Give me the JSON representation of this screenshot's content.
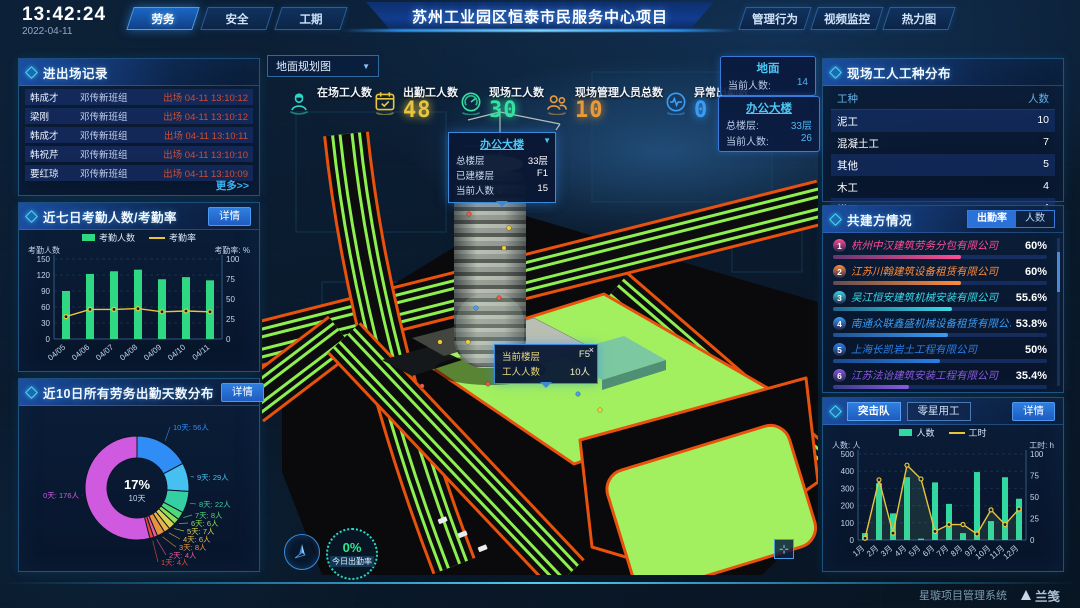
{
  "header": {
    "time": "13:42:24",
    "date": "2022-04-11",
    "left_tabs": [
      "劳务",
      "安全",
      "工期"
    ],
    "active_left_tab": "劳务",
    "title": "苏州工业园区恒泰市民服务中心项目",
    "right_tabs": [
      "管理行为",
      "视频监控",
      "热力图"
    ]
  },
  "entry_exit": {
    "title": "进出场记录",
    "more": "更多>>",
    "rows": [
      {
        "name": "韩成才",
        "team": "邓传新班组",
        "event": "出场 04-11 13:10:12"
      },
      {
        "name": "梁刚",
        "team": "邓传新班组",
        "event": "出场 04-11 13:10:12"
      },
      {
        "name": "韩成才",
        "team": "邓传新班组",
        "event": "出场 04-11 13:10:11"
      },
      {
        "name": "韩祝芹",
        "team": "邓传新班组",
        "event": "出场 04-11 13:10:10"
      },
      {
        "name": "要红琼",
        "team": "邓传新班组",
        "event": "出场 04-11 13:10:09"
      }
    ]
  },
  "panels": {
    "detail": "详情",
    "attendance7_title": "近七日考勤人数/考勤率",
    "distribution_title": "近10日所有劳务出勤天数分布",
    "worker_types": {
      "title": "现场工人工种分布",
      "col_type": "工种",
      "col_count": "人数",
      "rows": [
        [
          "泥工",
          "10"
        ],
        [
          "混凝土工",
          "7"
        ],
        [
          "其他",
          "5"
        ],
        [
          "木工",
          "4"
        ],
        [
          "塔司",
          "4"
        ]
      ]
    },
    "partners": {
      "title": "共建方情况",
      "tabs": [
        "出勤率",
        "人数"
      ],
      "active_tab": "出勤率",
      "rows": [
        {
          "rank": "1",
          "name": "杭州中汉建筑劳务分包有限公司",
          "value": "60%",
          "pct": 60,
          "color": "#ff4d94"
        },
        {
          "rank": "2",
          "name": "江苏川翰建筑设备租赁有限公司",
          "value": "60%",
          "pct": 60,
          "color": "#ff8c3a"
        },
        {
          "rank": "3",
          "name": "吴江恒安建筑机械安装有限公司",
          "value": "55.6%",
          "pct": 55.6,
          "color": "#3ad9e8"
        },
        {
          "rank": "4",
          "name": "南通众联鑫盛机械设备租赁有限公司",
          "value": "53.8%",
          "pct": 53.8,
          "color": "#3a9df5"
        },
        {
          "rank": "5",
          "name": "上海长凯岩土工程有限公司",
          "value": "50%",
          "pct": 50,
          "color": "#2a7fe8"
        },
        {
          "rank": "6",
          "name": "江苏法诒建筑安装工程有限公司",
          "value": "35.4%",
          "pct": 35.4,
          "color": "#8a5ae0"
        }
      ]
    },
    "assault": {
      "tabs": [
        "突击队",
        "零星用工"
      ],
      "active_tab": "突击队"
    }
  },
  "map": {
    "view_selector": "地面规划图",
    "stats": [
      {
        "icon": "worker-icon",
        "label": "在场工人数",
        "value": "",
        "color": "#2ad9c8"
      },
      {
        "icon": "calendar-check-icon",
        "label": "出勤工人数",
        "value": "48",
        "color": "#e8c53a"
      },
      {
        "icon": "gauge-icon",
        "label": "现场工人数",
        "value": "30",
        "color": "#35e0a1"
      },
      {
        "icon": "people-icon",
        "label": "现场管理人员总数",
        "value": "10",
        "color": "#e89a3a"
      },
      {
        "icon": "pulse-icon",
        "label": "异常出勤数",
        "value": "0",
        "color": "#3a9df5"
      }
    ],
    "ground_card": {
      "title": "地面",
      "label": "当前人数:",
      "value": "14"
    },
    "building_card": {
      "title": "办公大楼",
      "rows": [
        [
          "总楼层:",
          "33层"
        ],
        [
          "当前人数:",
          "26"
        ]
      ]
    },
    "building_tooltip": {
      "title": "办公大楼",
      "rows": [
        [
          "总楼层",
          "33层"
        ],
        [
          "已建楼层",
          "F1"
        ],
        [
          "当前人数",
          "15"
        ]
      ]
    },
    "floor_tooltip": {
      "rows": [
        [
          "当前楼层",
          "F5"
        ],
        [
          "工人人数",
          "10人"
        ]
      ],
      "close": "×"
    },
    "attendance_badge": {
      "pct": "0%",
      "label": "今日出勤率"
    }
  },
  "footer": {
    "system_name": "星璇项目管理系统",
    "logo": "兰笺"
  },
  "chart_data": [
    {
      "id": "attendance7",
      "type": "bar+line",
      "title": "近七日考勤人数/考勤率",
      "categories": [
        "04/05",
        "04/06",
        "04/07",
        "04/08",
        "04/09",
        "04/10",
        "04/11"
      ],
      "series": [
        {
          "name": "考勤人数",
          "type": "bar",
          "color": "#2fd984",
          "axis": "left",
          "values": [
            90,
            122,
            127,
            130,
            112,
            116,
            110
          ]
        },
        {
          "name": "考勤率",
          "type": "line",
          "color": "#e8c53a",
          "axis": "right",
          "values": [
            28,
            37,
            37,
            38,
            34,
            35,
            34
          ]
        }
      ],
      "left_axis": {
        "label": "考勤人数",
        "min": 0,
        "max": 150,
        "ticks": [
          0,
          30,
          60,
          90,
          120,
          150
        ]
      },
      "right_axis": {
        "label": "考勤率: %",
        "min": 0,
        "max": 100,
        "ticks": [
          0,
          25,
          50,
          75,
          100
        ]
      },
      "legend_position": "top"
    },
    {
      "id": "attendance-days-distribution",
      "type": "pie",
      "title": "近10日所有劳务出勤天数分布",
      "center_label": {
        "pct": "17%",
        "text": "10天"
      },
      "slices": [
        {
          "label": "10天",
          "value": 56,
          "color": "#2f8df5"
        },
        {
          "label": "9天",
          "value": 29,
          "color": "#45c0f0"
        },
        {
          "label": "8天",
          "value": 22,
          "color": "#34cfa2"
        },
        {
          "label": "7天",
          "value": 8,
          "color": "#4ed978"
        },
        {
          "label": "6天",
          "value": 6,
          "color": "#8edc5a"
        },
        {
          "label": "5天",
          "value": 7,
          "color": "#d8d24e"
        },
        {
          "label": "4天",
          "value": 6,
          "color": "#e8b44a"
        },
        {
          "label": "3天",
          "value": 8,
          "color": "#e8923f"
        },
        {
          "label": "2天",
          "value": 4,
          "color": "#e85a9a"
        },
        {
          "label": "1天",
          "value": 4,
          "color": "#e84a3a"
        },
        {
          "label": "0天",
          "value": 176,
          "color": "#cf5ae0"
        }
      ],
      "unit": "人"
    },
    {
      "id": "assault-team",
      "type": "bar+line",
      "title": "突击队",
      "categories": [
        "1月",
        "2月",
        "3月",
        "4月",
        "5月",
        "6月",
        "7月",
        "8月",
        "9月",
        "10月",
        "11月",
        "12月"
      ],
      "series": [
        {
          "name": "人数",
          "type": "bar",
          "color": "#2fd9a0",
          "axis": "left",
          "values": [
            40,
            330,
            155,
            365,
            8,
            335,
            210,
            40,
            395,
            110,
            365,
            240
          ]
        },
        {
          "name": "工时",
          "type": "line",
          "color": "#e8c53a",
          "axis": "right",
          "values": [
            2,
            70,
            8,
            87,
            71,
            10,
            18,
            18,
            7,
            35,
            18,
            36
          ]
        }
      ],
      "left_axis": {
        "label": "人数: 人",
        "min": 0,
        "max": 500,
        "ticks": [
          0,
          100,
          200,
          300,
          400,
          500
        ]
      },
      "right_axis": {
        "label": "工时: h",
        "min": 0,
        "max": 100,
        "ticks": [
          0,
          25,
          50,
          75,
          100
        ]
      },
      "legend_position": "top",
      "area_under_line": true
    }
  ]
}
